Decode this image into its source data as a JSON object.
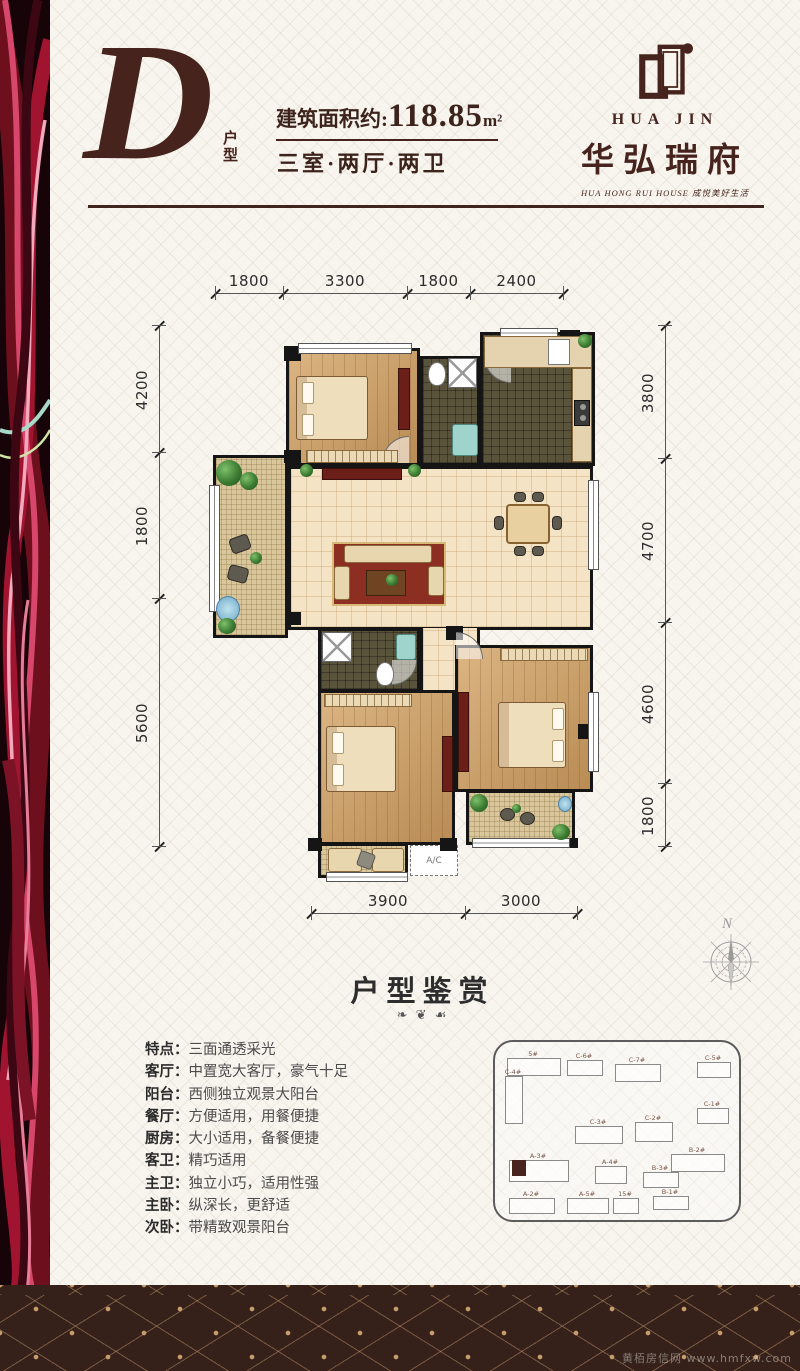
{
  "header": {
    "type_letter": "D",
    "type_label": "户型",
    "area_prefix": "建筑面积约:",
    "area_value": "118.85",
    "area_unit": "m²",
    "layout_text": "三室·两厅·两卫",
    "brand": {
      "logo_en": "HUA JIN",
      "name_cn": "华弘瑞府",
      "tagline": "HUA HONG RUI HOUSE   成悦美好生活"
    }
  },
  "floorplan": {
    "dims_top": [
      "1800",
      "3300",
      "1800",
      "2400"
    ],
    "dims_left": [
      "4200",
      "1800",
      "5600"
    ],
    "dims_right": [
      "3800",
      "4700",
      "4600",
      "1800"
    ],
    "dims_bottom": [
      "3900",
      "3000"
    ],
    "ac_label": "A/C"
  },
  "section": {
    "title": "户型鉴赏",
    "ornament": "❧ ❦ ☙"
  },
  "features": {
    "colon": "：",
    "items": [
      {
        "label": "特点",
        "text": "三面通透采光"
      },
      {
        "label": "客厅",
        "text": "中置宽大客厅，豪气十足"
      },
      {
        "label": "阳台",
        "text": "西侧独立观景大阳台"
      },
      {
        "label": "餐厅",
        "text": "方便适用，用餐便捷"
      },
      {
        "label": "厨房",
        "text": "大小适用，备餐便捷"
      },
      {
        "label": "客卫",
        "text": "精巧适用"
      },
      {
        "label": "主卫",
        "text": "独立小巧，适用性强"
      },
      {
        "label": "主卧",
        "text": "纵深长，更舒适"
      },
      {
        "label": "次卧",
        "text": "带精致观景阳台"
      }
    ]
  },
  "siteplan": {
    "buildings": [
      {
        "label": "5#",
        "x": 12,
        "y": 16,
        "w": 52,
        "h": 16,
        "hl": false
      },
      {
        "label": "C-6#",
        "x": 72,
        "y": 18,
        "w": 34,
        "h": 14,
        "hl": false
      },
      {
        "label": "C-7#",
        "x": 120,
        "y": 22,
        "w": 44,
        "h": 16,
        "hl": false
      },
      {
        "label": "C-5#",
        "x": 202,
        "y": 20,
        "w": 32,
        "h": 14,
        "hl": false
      },
      {
        "label": "C-4#",
        "x": 10,
        "y": 34,
        "w": 16,
        "h": 46,
        "hl": false
      },
      {
        "label": "C-1#",
        "x": 202,
        "y": 66,
        "w": 30,
        "h": 14,
        "hl": false
      },
      {
        "label": "C-3#",
        "x": 80,
        "y": 84,
        "w": 46,
        "h": 16,
        "hl": false
      },
      {
        "label": "C-2#",
        "x": 140,
        "y": 80,
        "w": 36,
        "h": 18,
        "hl": false
      },
      {
        "label": "A-3#",
        "x": 14,
        "y": 118,
        "w": 58,
        "h": 20,
        "hl": false
      },
      {
        "label": "",
        "x": 17,
        "y": 118,
        "w": 12,
        "h": 14,
        "hl": true
      },
      {
        "label": "A-4#",
        "x": 100,
        "y": 124,
        "w": 30,
        "h": 16,
        "hl": false
      },
      {
        "label": "B-2#",
        "x": 176,
        "y": 112,
        "w": 52,
        "h": 16,
        "hl": false
      },
      {
        "label": "B-3#",
        "x": 148,
        "y": 130,
        "w": 34,
        "h": 14,
        "hl": false
      },
      {
        "label": "A-2#",
        "x": 14,
        "y": 156,
        "w": 44,
        "h": 14,
        "hl": false
      },
      {
        "label": "A-5#",
        "x": 72,
        "y": 156,
        "w": 40,
        "h": 14,
        "hl": false
      },
      {
        "label": "15#",
        "x": 118,
        "y": 156,
        "w": 24,
        "h": 14,
        "hl": false
      },
      {
        "label": "B-1#",
        "x": 158,
        "y": 154,
        "w": 34,
        "h": 12,
        "hl": false
      }
    ]
  },
  "compass": {
    "label": "N"
  },
  "watermark": "黄栢房信网 www.hmfxw.com",
  "colors": {
    "brand_brown": "#46241d",
    "footer_brown": "#35201a",
    "accent_gold": "#c79e6b"
  }
}
